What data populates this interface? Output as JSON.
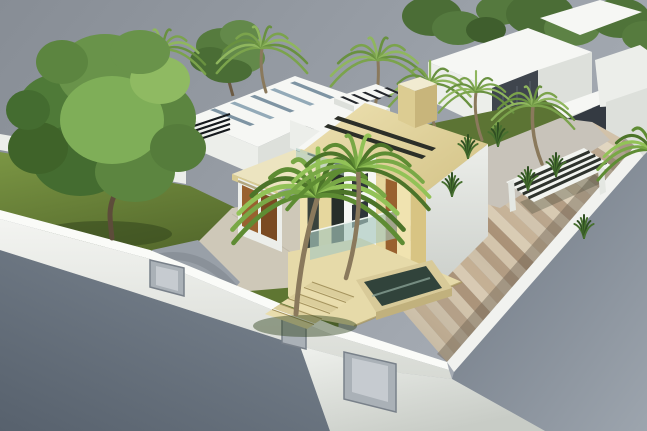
{
  "scene": {
    "kind": "3d-architectural-render",
    "subject": "modern-villa-with-garden-palms-and-deck"
  },
  "colors": {
    "sky_left": "#878d95",
    "sky_right": "#a8aeb6",
    "street_left_dark": "#57616d",
    "street_left_light": "#7a848f",
    "street_right_dark": "#6d7682",
    "street_right_light": "#9da5ae",
    "wall_top": "#fafbf8",
    "wall_face_light": "#f3f4f1",
    "wall_face_dark": "#d7dad4",
    "bottom_wall_light": "#eff1ed",
    "bottom_wall_dark": "#c8ccc6",
    "fascia": "#f1f2ef",
    "gate_fill": "#aab1b7",
    "gate_light": "#c6cbd0",
    "gate_frame": "#79818a",
    "lawn_light": "#7b9644",
    "lawn_dark": "#4e6228",
    "lawn_mid": "#5f7632",
    "lawn_back": "#5c7434",
    "shadow_green": "#2e401a",
    "curb": "#8a9199",
    "drive_gray": "#99a0a8",
    "drive_gray_dark": "#7e858e",
    "apron": "#cec8b8",
    "apron_line": "#b8b1a1",
    "roof_light": "#eee2b2",
    "roof_dark": "#d6c68c",
    "roof_fascia": "#f5eecb",
    "roof_slot": "#2c2f28",
    "chimney_top": "#f1ebd1",
    "chimney_sw": "#dccc92",
    "chimney_se": "#c8b57b",
    "white_top": "#f6f7f4",
    "white_face": "#eceeea",
    "white_shade": "#dde0db",
    "white_dark": "#c9cdc8",
    "slate": "#3f454d",
    "slate_dark": "#343a42",
    "slate_line": "#5d656e",
    "doorway_glass": "#3c4440",
    "railing_dark": "#15191d",
    "window_dark": "#2e343a",
    "glass_balustrade": "#a8c8bf",
    "terrace": "#e6daa9",
    "terrace_dark": "#cfc08c",
    "waterbox": "#d8ca99",
    "waterbox_face": "#c1b17d",
    "water": "#31433b",
    "water_light": "#93ab9f",
    "pergola_white": "#f2f4f0",
    "pergola_slat": "#2e332d",
    "pergola_leg": "#e4e7e2",
    "plant_dark": "#2f4f22",
    "plant_mid": "#47702f",
    "palm_trunk": "#8a795c",
    "tree_trunk": "#5d4c3a",
    "garage_shadow": "#b3a77f",
    "wood": "#99612f",
    "wood_dark": "#7a4a22"
  },
  "deck": {
    "count": 26,
    "inner": [
      [
        352,
        252
      ],
      [
        592,
        122
      ]
    ],
    "outer": [
      [
        447,
        362
      ],
      [
        635,
        146
      ]
    ],
    "palette": [
      "#d7c9b1",
      "#c2ad91",
      "#cdbfa8",
      "#b29c82",
      "#d2c3aa",
      "#a78e73"
    ]
  },
  "facade": {
    "a": [
      300,
      150
    ],
    "b": [
      426,
      192
    ],
    "h": 106,
    "stripes": [
      {
        "f": 0.0,
        "w": 0.06,
        "c": "#f0e3b0",
        "n": "facade-pilaster"
      },
      {
        "f": 0.06,
        "w": 0.09,
        "c": "#39423c",
        "n": "facade-window"
      },
      {
        "f": 0.15,
        "w": 0.1,
        "c": "#e6d79e",
        "n": "facade-pilaster"
      },
      {
        "f": 0.25,
        "w": 0.1,
        "c": "#272e2a",
        "n": "facade-window"
      },
      {
        "f": 0.35,
        "w": 0.12,
        "c": "#f0e3b0",
        "n": "facade-pilaster"
      },
      {
        "f": 0.47,
        "w": 0.1,
        "c": "#39423c",
        "n": "facade-window"
      },
      {
        "f": 0.57,
        "w": 0.11,
        "c": "#e6d79e",
        "n": "facade-pilaster"
      },
      {
        "f": 0.68,
        "w": 0.09,
        "c": "#99612f",
        "n": "front-door-wood"
      },
      {
        "f": 0.77,
        "w": 0.11,
        "c": "#f0e3b0",
        "n": "facade-pilaster"
      },
      {
        "f": 0.88,
        "w": 0.12,
        "c": "#d8c483",
        "n": "facade-pilaster"
      }
    ]
  },
  "steps": {
    "count": 6,
    "o": [
      312,
      282
    ],
    "step": [
      -8,
      5.5
    ],
    "lv": [
      42,
      15
    ],
    "tv": [
      -7,
      4.5
    ],
    "c1": "#e9ddad",
    "c2": "#dbce9c",
    "edge": "#a5945e"
  },
  "skylights": {
    "a": [
      210,
      110
    ],
    "b": [
      290,
      83
    ],
    "v": [
      40,
      16
    ],
    "u": [
      4.7,
      -1.6
    ],
    "n": 5,
    "c1": "#93aab8",
    "c2": "#7e94a3"
  },
  "villa_skylight_slats": {
    "a": [
      340,
      97
    ],
    "b": [
      384,
      88
    ],
    "v": [
      16,
      7
    ],
    "u": [
      3.4,
      -0.8
    ],
    "n": 5,
    "c": "#23262b"
  },
  "pergola_slats": {
    "e1": [
      [
        506,
        182
      ],
      [
        534,
        202
      ]
    ],
    "e2": [
      [
        584,
        148
      ],
      [
        612,
        166
      ]
    ],
    "n": 4,
    "w": 3
  },
  "plants": {
    "positions": [
      [
        468,
        158
      ],
      [
        498,
        146
      ],
      [
        452,
        196
      ],
      [
        556,
        176
      ],
      [
        584,
        238
      ],
      [
        528,
        190
      ]
    ]
  },
  "big_tree": {
    "blobs": [
      [
        58,
        108,
        40,
        34,
        "#4f7a38"
      ],
      [
        105,
        72,
        48,
        38,
        "#69934a"
      ],
      [
        152,
        118,
        44,
        38,
        "#5c8540"
      ],
      [
        80,
        160,
        48,
        36,
        "#446c30"
      ],
      [
        135,
        172,
        40,
        30,
        "#5c8540"
      ],
      [
        38,
        148,
        30,
        26,
        "#3f6329"
      ],
      [
        112,
        120,
        52,
        44,
        "#7fae58"
      ],
      [
        160,
        80,
        30,
        24,
        "#8fba62"
      ],
      [
        178,
        148,
        28,
        24,
        "#557c3b"
      ],
      [
        62,
        62,
        26,
        22,
        "#5c8540"
      ],
      [
        140,
        52,
        30,
        22,
        "#69934a"
      ],
      [
        28,
        110,
        22,
        20,
        "#446c30"
      ]
    ]
  },
  "pine": {
    "blobs": [
      [
        222,
        46,
        26,
        18,
        "#567b3e"
      ],
      [
        240,
        34,
        20,
        14,
        "#63894a"
      ],
      [
        210,
        60,
        20,
        13,
        "#4a6d35"
      ],
      [
        243,
        58,
        22,
        15,
        "#63894a"
      ],
      [
        228,
        71,
        24,
        12,
        "#4a6d35"
      ]
    ]
  },
  "bg_trees": {
    "blobs": [
      [
        432,
        16,
        30,
        20,
        "#4b6d36"
      ],
      [
        458,
        28,
        26,
        17,
        "#557a3f"
      ],
      [
        500,
        10,
        24,
        15,
        "#55793e"
      ],
      [
        540,
        14,
        34,
        22,
        "#4b6d36"
      ],
      [
        572,
        28,
        28,
        18,
        "#5d8245"
      ],
      [
        620,
        18,
        30,
        20,
        "#4f7339"
      ],
      [
        644,
        36,
        22,
        15,
        "#567b3e"
      ],
      [
        486,
        30,
        20,
        13,
        "#3f5e2d"
      ]
    ]
  },
  "palms": {
    "bg_colors": [
      "#7ba34c",
      "#8fb65e",
      "#699140"
    ],
    "fg_colors": [
      "#5e8c33",
      "#79a846",
      "#92c257",
      "#4c7429"
    ],
    "background": [
      {
        "x": 118,
        "y": 64,
        "s": 34,
        "fr": 9,
        "tb": [
          122,
          140
        ],
        "bend": 116,
        "tw": 3
      },
      {
        "x": 162,
        "y": 50,
        "s": 44,
        "fr": 10,
        "tb": [
          158,
          140
        ],
        "bend": 163,
        "tw": 3
      },
      {
        "x": 262,
        "y": 48,
        "s": 46,
        "fr": 10,
        "tb": [
          266,
          92
        ],
        "bend": 259,
        "tw": 3
      },
      {
        "x": 378,
        "y": 60,
        "s": 48,
        "fr": 10,
        "tb": [
          372,
          120
        ],
        "bend": 380,
        "tw": 3
      },
      {
        "x": 430,
        "y": 84,
        "s": 42,
        "fr": 9,
        "tb": [
          436,
          130
        ],
        "bend": 427,
        "tw": 3
      },
      {
        "x": 476,
        "y": 92,
        "s": 38,
        "fr": 9,
        "tb": [
          482,
          140
        ],
        "bend": 473,
        "tw": 3
      },
      {
        "x": 533,
        "y": 106,
        "s": 42,
        "fr": 10,
        "tb": [
          542,
          164
        ],
        "bend": 530,
        "tw": 3.5
      }
    ],
    "foreground": [
      {
        "x": 318,
        "y": 196,
        "s": 86,
        "fr": 13,
        "tb": [
          296,
          314
        ],
        "bend": 300,
        "tw": 5
      },
      {
        "x": 358,
        "y": 170,
        "s": 72,
        "fr": 12,
        "tb": [
          346,
          278
        ],
        "bend": 362,
        "tw": 4.5
      },
      {
        "x": 652,
        "y": 150,
        "s": 55,
        "fr": 11
      }
    ]
  }
}
